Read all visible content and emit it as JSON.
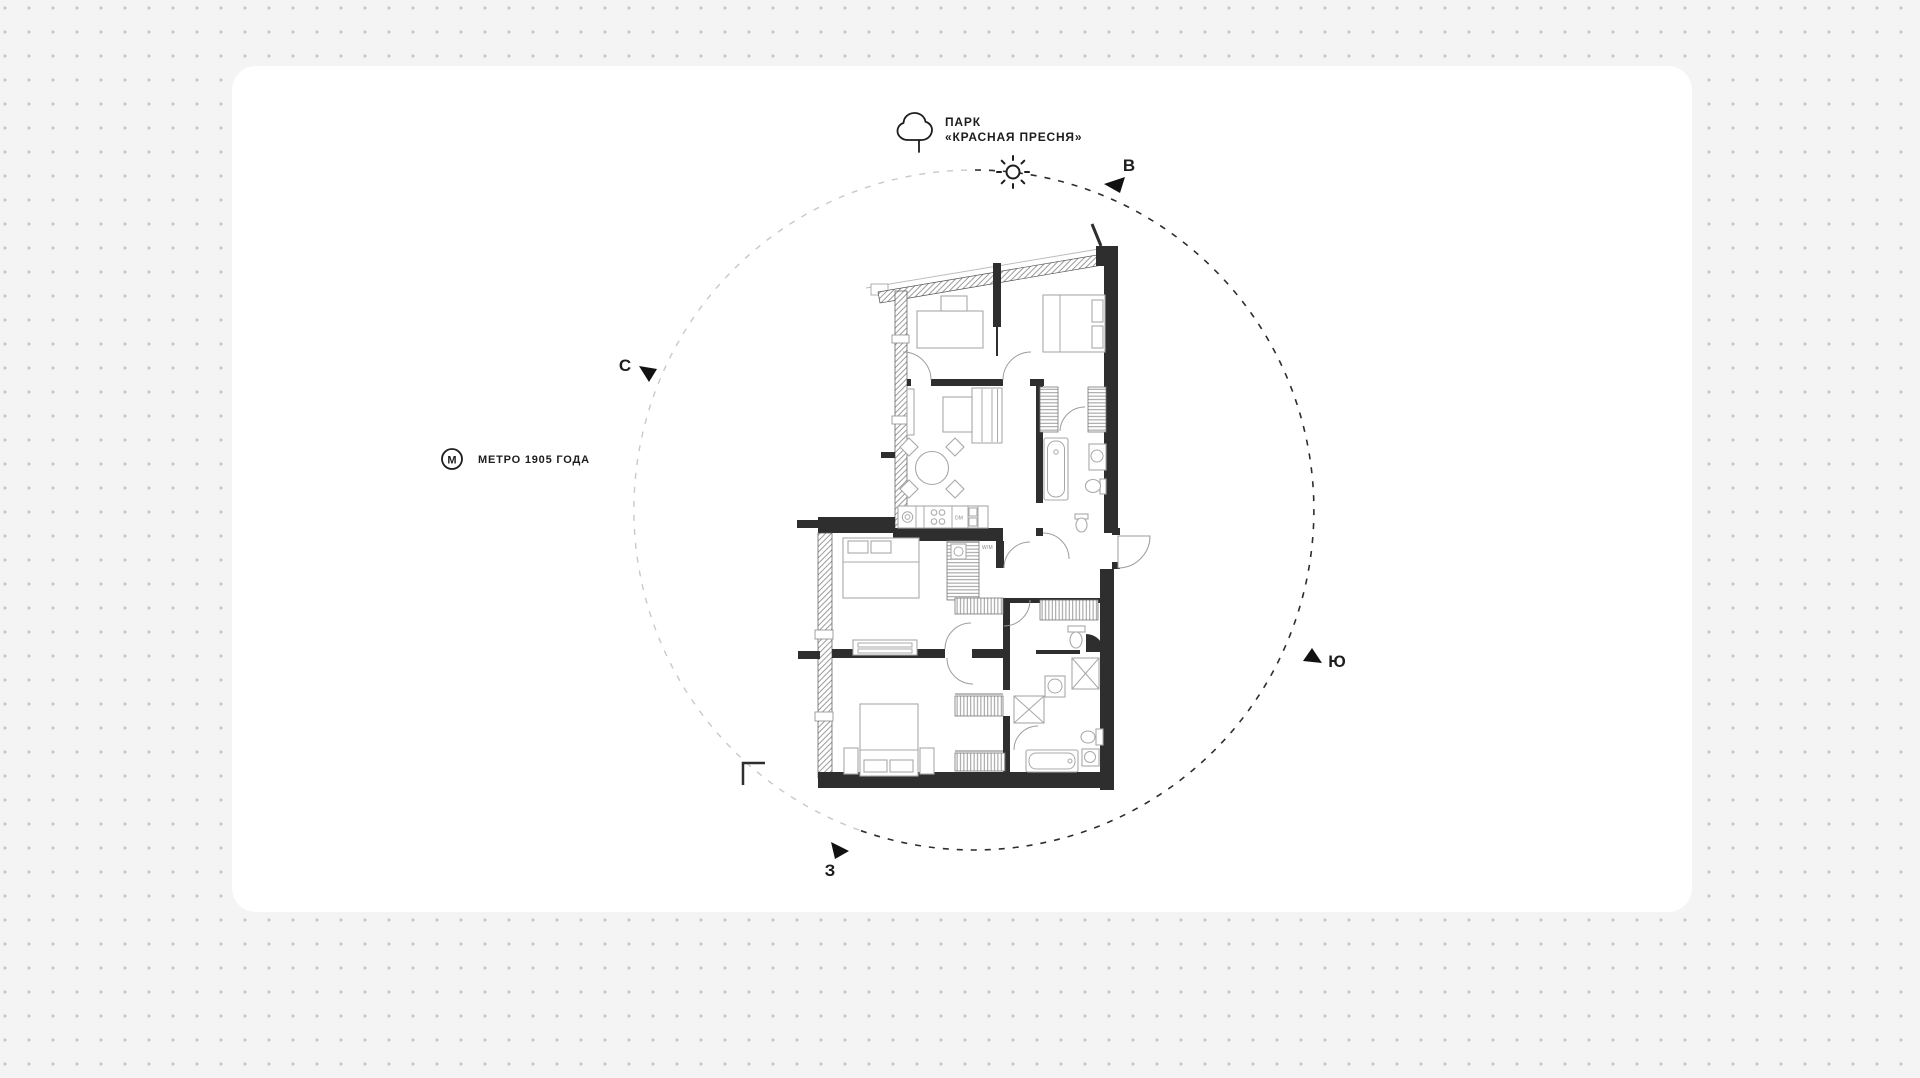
{
  "colors": {
    "page_bg": "#f4f4f4",
    "dot": "#c6c6c6",
    "panel": "#ffffff",
    "ink": "#1d1d1d",
    "wall": "#2e2e2e",
    "furniture_stroke": "#a8a8a8",
    "circle_dark": "#2e2e2e",
    "circle_light": "#c9c9c9"
  },
  "landmarks": {
    "park": {
      "icon": "tree-icon",
      "line1": "ПАРК",
      "line2": "«КРАСНАЯ ПРЕСНЯ»"
    },
    "metro": {
      "icon": "metro-icon",
      "symbol": "М",
      "label": "МЕТРО 1905 ГОДА"
    }
  },
  "compass": {
    "north": {
      "label": "С"
    },
    "east": {
      "label": "В"
    },
    "south": {
      "label": "Ю"
    },
    "west": {
      "label": "З"
    }
  },
  "plan_labels": {
    "dishwasher": "DM",
    "washer": "W/M"
  }
}
